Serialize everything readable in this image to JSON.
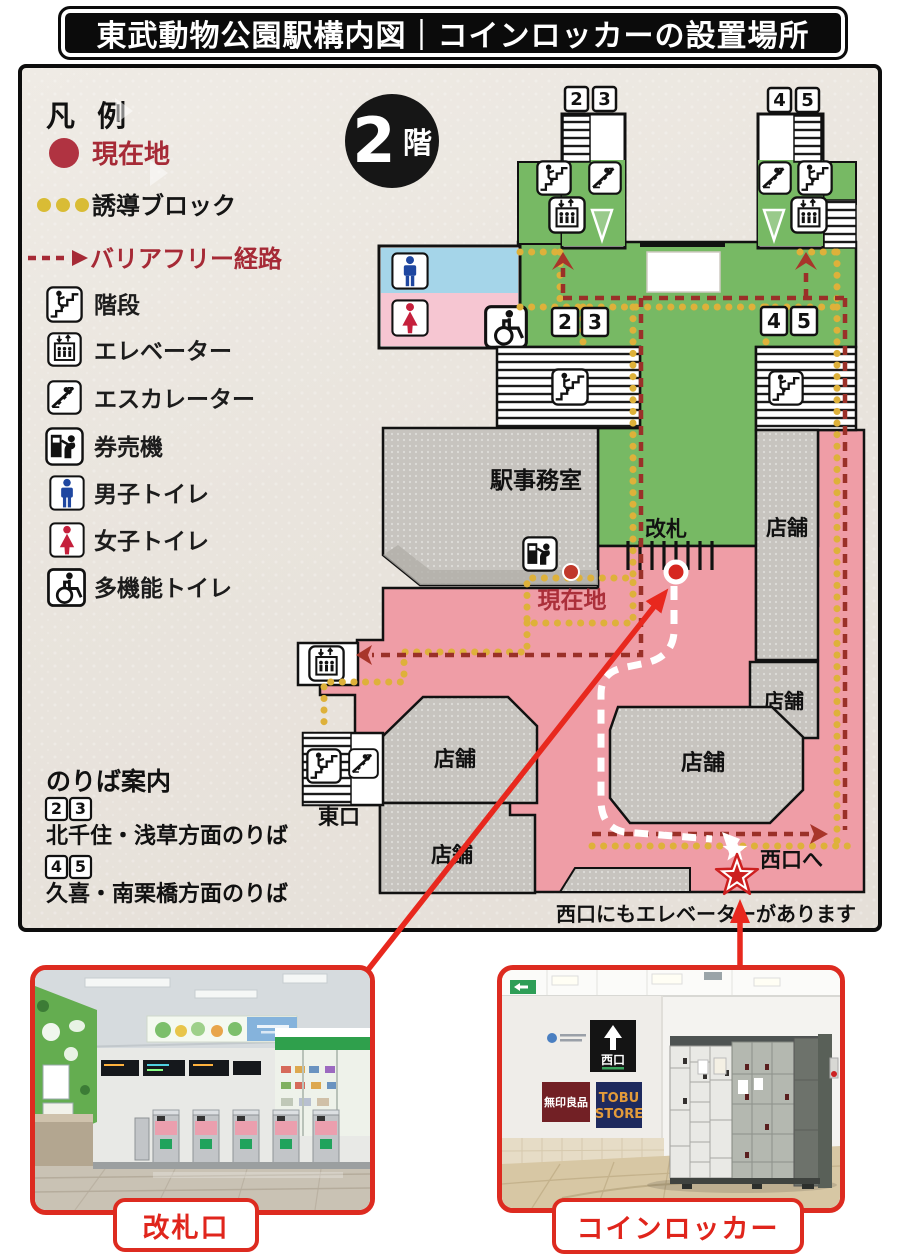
{
  "title": "東武動物公園駅構内図｜コインロッカーの設置場所",
  "floor_badge": {
    "number": "2",
    "suffix": "階"
  },
  "legend": {
    "heading": "凡 例",
    "current_location": "現在地",
    "guidance_block": "誘導ブロック",
    "barrier_free": "バリアフリー経路",
    "stairs": "階段",
    "elevator": "エレベーター",
    "escalator": "エスカレーター",
    "ticket_machine": "券売機",
    "mens_toilet": "男子トイレ",
    "womens_toilet": "女子トイレ",
    "multifunction_toilet": "多機能トイレ"
  },
  "map": {
    "signs": {
      "p2": "2",
      "p3": "3",
      "p4": "4",
      "p5": "5"
    },
    "station_office": "駅事務室",
    "gate": "改札",
    "current_location": "現在地",
    "east_exit": "東口",
    "to_west_exit": "西口へ",
    "shop": "店舗",
    "note": "西口にもエレベーターがあります"
  },
  "platform_guide": {
    "heading": "のりば案内",
    "entry1": {
      "p1": "2",
      "p2": "3",
      "label": "北千住・浅草方面のりば"
    },
    "entry2": {
      "p1": "4",
      "p2": "5",
      "label": "久喜・南栗橋方面のりば"
    }
  },
  "photos": {
    "gate": {
      "caption": "改札口"
    },
    "locker": {
      "caption": "コインロッカー",
      "west_exit_sign": "西口",
      "muji_sign": "無印良品",
      "tobu_line1": "TOBU",
      "tobu_line2": "STORE"
    }
  },
  "colors": {
    "accent_red": "#e0251c",
    "route_red": "#9a3028",
    "guidance_yellow": "#deb13a",
    "paid_area_green": "#77b964",
    "free_area_pink": "#ef9da6",
    "mens_blue": "#a5d5e9",
    "womens_pink": "#f6c6d2",
    "shop_gray": "#c7c4bf"
  }
}
